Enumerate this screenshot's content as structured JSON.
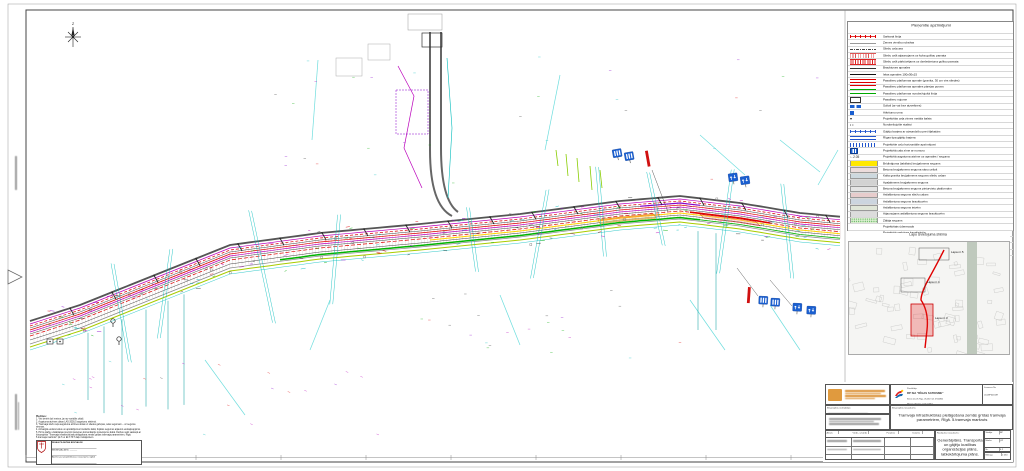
{
  "sheet": {
    "north_label": "Z"
  },
  "legend": {
    "title": "Pieņemtie apzīmējumi",
    "items": [
      {
        "label": "Sarkanā līnija",
        "swatch": {
          "type": "line-ticks",
          "color": "#dd0000"
        }
      },
      {
        "label": "Zemes vienību robežas",
        "swatch": {
          "type": "line",
          "color": "#999999"
        }
      },
      {
        "label": "Sliežu ceļa ass",
        "swatch": {
          "type": "dashdot",
          "color": "#444444"
        }
      },
      {
        "label": "Sliežu ceļš atjaunojams uz koka gulšņu pamata",
        "swatch": {
          "type": "hatch",
          "color": "#dd5555"
        }
      },
      {
        "label": "Sliežu ceļš pārbūvējams uz dzelzsbetona gulšņu pamata",
        "swatch": {
          "type": "hatch-dense",
          "color": "#dd2222"
        }
      },
      {
        "label": "Brauktuves apmales",
        "swatch": {
          "type": "line",
          "color": "#333333"
        }
      },
      {
        "label": "Ielas apmales 100x30x15",
        "swatch": {
          "type": "line-thick",
          "color": "#111111"
        }
      },
      {
        "label": "Pasažieru platformas apmale (granīta, 30 cm virs sliedes)",
        "swatch": {
          "type": "dline",
          "color": "#dd0000"
        }
      },
      {
        "label": "Pasažieru platformas apmales pārejas posms",
        "swatch": {
          "type": "dline",
          "color": "#dd0000",
          "color2": "#00aa00"
        }
      },
      {
        "label": "Pasažieru platformas norobežojošā līnija",
        "swatch": {
          "type": "line",
          "color": "#00aa00"
        }
      },
      {
        "label": "Pasažieru nojume",
        "swatch": {
          "type": "icon-rect",
          "color": "#333333"
        }
      },
      {
        "label": "Soliņš (ar vai bez atzveltnes)",
        "swatch": {
          "type": "icon-bench",
          "color": "#1a5fd0"
        }
      },
      {
        "label": "Atkritumu urna",
        "swatch": {
          "type": "icon-bin",
          "color": "#1a5fd0"
        }
      },
      {
        "label": "Projektētās ceļa zīmes metāla balsts",
        "swatch": {
          "type": "symbol",
          "color": "#222222"
        }
      },
      {
        "label": "Norobežojošie stabiņi",
        "swatch": {
          "type": "dots",
          "color": "#222222"
        }
      },
      {
        "label": "Gājēju barjera ar aizsardzību pret šļakatām",
        "swatch": {
          "type": "line-ticks",
          "color": "#2255cc"
        }
      },
      {
        "label": "Rīgas tipa gājēju barjera",
        "swatch": {
          "type": "dline",
          "color": "#2255cc"
        }
      },
      {
        "label": "Projektētie ceļu horizontālie apzīmējumi",
        "swatch": {
          "type": "blue-hatch",
          "color": "#2255cc"
        }
      },
      {
        "label": "Projektētā ceļa zīme ar numuru",
        "swatch": {
          "type": "icon-sign",
          "color": "#1a5fd0"
        }
      },
      {
        "label": "Projektētā augstuma atzīme uz apmales / seguma",
        "swatch": {
          "type": "mark",
          "color": "#222222"
        }
      },
      {
        "label": "Brīdinājuma (taktilais) bruģakmens segums",
        "swatch": {
          "type": "fill",
          "color": "#ffe800"
        }
      },
      {
        "label": "Betona bruģakmens seguma sānu celiņš",
        "swatch": {
          "type": "fill",
          "color": "#ecdcdc"
        }
      },
      {
        "label": "Kalta granīta bruģakmens segums sliežu ceļam",
        "swatch": {
          "type": "fill",
          "color": "#cdd8de"
        }
      },
      {
        "label": "Apaļakmens bruģakmens segums",
        "swatch": {
          "type": "fill",
          "color": "#d2d2d2"
        }
      },
      {
        "label": "Betona bruģakmens segums pieturvietu platformām",
        "swatch": {
          "type": "fill",
          "color": "#e4e4e4"
        }
      },
      {
        "label": "Asfaltbetona segums sliežu ceļam",
        "swatch": {
          "type": "fill",
          "color": "#e7cccc"
        }
      },
      {
        "label": "Asfaltbetona segums brauktuvēm",
        "swatch": {
          "type": "fill",
          "color": "#ccd5df"
        }
      },
      {
        "label": "Asfaltbetona segums ietvēm",
        "swatch": {
          "type": "fill",
          "color": "#e0e6d8"
        }
      },
      {
        "label": "Atjaunojams asfaltbetona segums brauktuvēm",
        "swatch": {
          "type": "fill",
          "color": "#dcdcdc"
        }
      },
      {
        "label": "Zālāja segums",
        "swatch": {
          "type": "fill-dots",
          "color": "#ddefd2",
          "color2": "#44aa44"
        }
      },
      {
        "label": "Projektētais ūdensvads",
        "swatch": {
          "type": "dashed",
          "color": "#009900"
        }
      },
      {
        "label": "Projektētā sadzīves kanalizācija",
        "swatch": {
          "type": "line",
          "color": "#aa4422"
        }
      },
      {
        "label": "Projektētā lietus ūdens kanalizācija",
        "swatch": {
          "type": "line",
          "color": "#00aa00"
        }
      },
      {
        "label": "Pārceļamā tramvaja sliežu ceļu drenāža",
        "swatch": {
          "type": "dashdot",
          "color": "#2244cc"
        }
      },
      {
        "label": "TKT kabeļi un vircaurules (izstrādāti atsevišķā būvprojektā)",
        "swatch": {
          "type": "dashed",
          "color": "#555555"
        }
      },
      {
        "label": "ELT-TKT kabeļi (izstrādāti atsevišķā būvprojektā)",
        "swatch": {
          "type": "dashdot",
          "color": "#555555"
        }
      }
    ]
  },
  "map": {
    "title": "Lapu izvietojuma shēma",
    "sheets": [
      {
        "label": "Lapa nr.5"
      },
      {
        "label": "Lapa nr.4"
      },
      {
        "label": "Lapa nr.3"
      }
    ]
  },
  "notes": {
    "title": "Piezīmes:",
    "items": [
      "1. Visi izmēri doti metros, ja nav norādīts citādi.",
      "2. Augstuma atzīmes dotas LAS-2000,5 augstumu sistēmā.",
      "3. Tramvaja sliežu ceļa augstuma atzīmes dotas uz sliedes galviņas, ielas segumam – uz seguma virsmas.",
      "4. Aizsargāt esošos kokus un apstādījumus būvdarbu laikā; bojātos segumus atjaunot esošajā apjomā.",
      "5. Pirms darbu uzsākšanas precizēt pazemes komunikāciju novietojumu dabā. Darbus veikt saskaņā ar būvprojekta \"Tramvaja infrastruktūras pielāgošana zemās grīdas tramvaja parametriem, Rīgā. 5.tramvaja maršruts\" ĢLT un ELT-TKT daļu risinājumiem."
    ]
  },
  "stamp": {
    "org": "RĪGAS PILSĒTAS BŪVVALDE",
    "doc_no_label": "Nr.",
    "rows": [
      "BŪVATĻAUJA",
      "Atzīme par projektēšanas nosacījumu izpildi",
      "Atzīme par būvdarbu uzsākšanas nosacījumu izpildi"
    ]
  },
  "title_block": {
    "designer_label": "Būvprojekta izstrādātājs:",
    "client_label": "Pasūtītājs:",
    "client_name": "RP SIA \"RĪGAS SATIKSME\"",
    "client_addr": "Kleistu iela 28, Rīga, LV-1067, tālr. 67104800",
    "authority_name": "Rīgas pilsētas pašvaldība",
    "authority_addr": "Rātslaukums 1, Rīga, LV-1539",
    "licence_label": "Licences Nr.",
    "licence_no": "LD-MP000187",
    "project_label": "Būvprojekta nosaukums:",
    "project_title": "Tramvaja infrastruktūras pielāgošana zemās grīdas tramvaja parametriem, Rīgā. 5.tramvaja maršruts",
    "drawing_label": "Rasējuma nosaukums:",
    "drawing_title": "Ģenerālplāns. Transporta un gājēju kustības organizācijas plāns, labiekārtojuma plāns.",
    "sig_cols": [
      "Amats",
      "Vārds, uzvārds",
      "Paraksts",
      "Datums"
    ],
    "stage_label": "Stadija",
    "stage": "BP",
    "mark_label": "Marka",
    "mark": "ĢP",
    "num_label": "Nr.",
    "num": "4.2",
    "scale_label": "Mērogs",
    "scale": "1:250"
  }
}
